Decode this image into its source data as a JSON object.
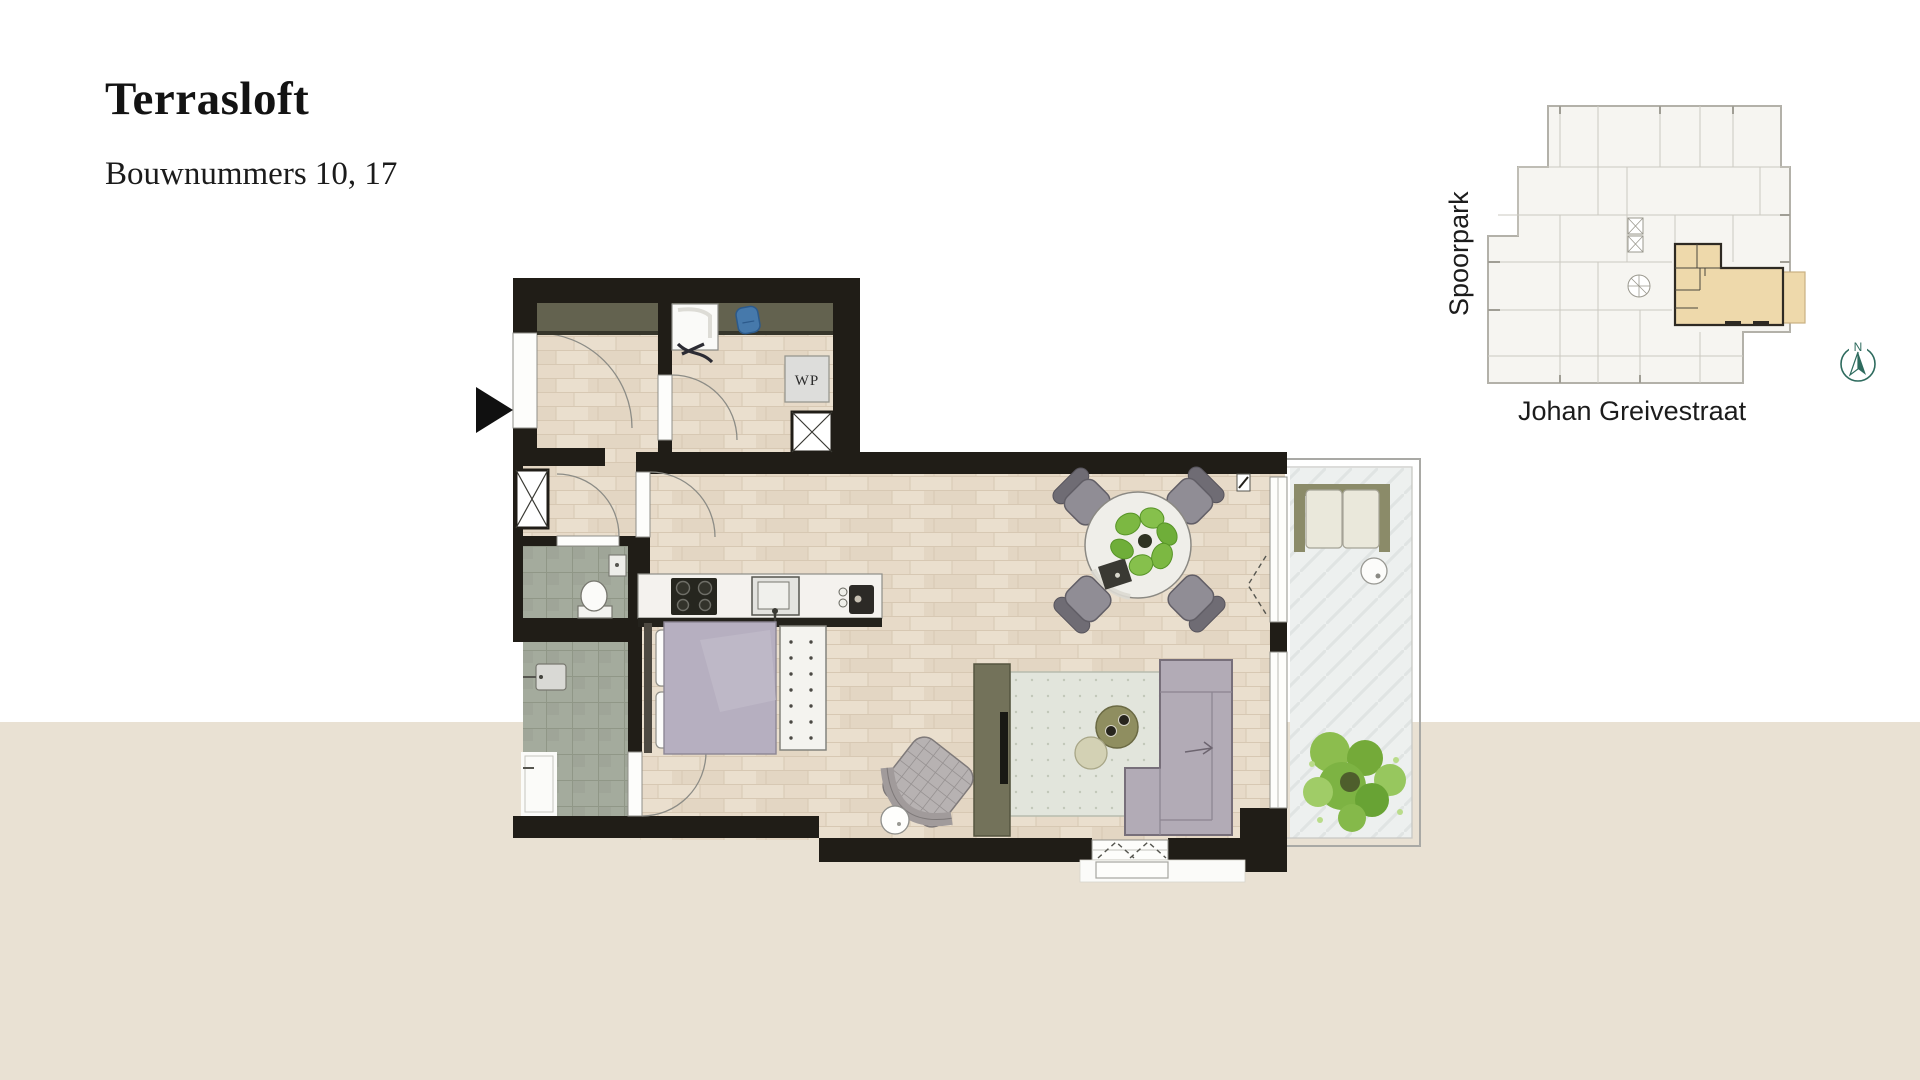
{
  "page": {
    "width": 1920,
    "height": 1080,
    "background_color": "#ffffff",
    "bottom_band_color": "#e9e1d3"
  },
  "header": {
    "title": "Terrasloft",
    "subtitle": "Bouwnummers 10, 17"
  },
  "floor_plan": {
    "heat_pump_label": "WP",
    "colors": {
      "wall": "#201d17",
      "wood_floor": "#eadfce",
      "bathroom_tile": "#a4ab9d",
      "terrace_floor": "#edf0ef",
      "wardrobe_strip": "#63624f",
      "kitchen_counter": "#f4f2ee",
      "bed_duvet": "#b6afc0",
      "sofa": "#b2abb6",
      "rug": "#e2e5dc",
      "plant_green": "#7cb842",
      "tv_cabinet": "#73725a"
    }
  },
  "locator_map": {
    "park_label": "Spoorpark",
    "street_label": "Johan Greivestraat",
    "building_fill": "#f6f5f1",
    "building_line": "#b3b1a9",
    "highlight_fill": "#eed9ab",
    "highlight_outline": "#2e2a23"
  },
  "compass": {
    "north_label": "N",
    "color": "#2e6b5e"
  }
}
